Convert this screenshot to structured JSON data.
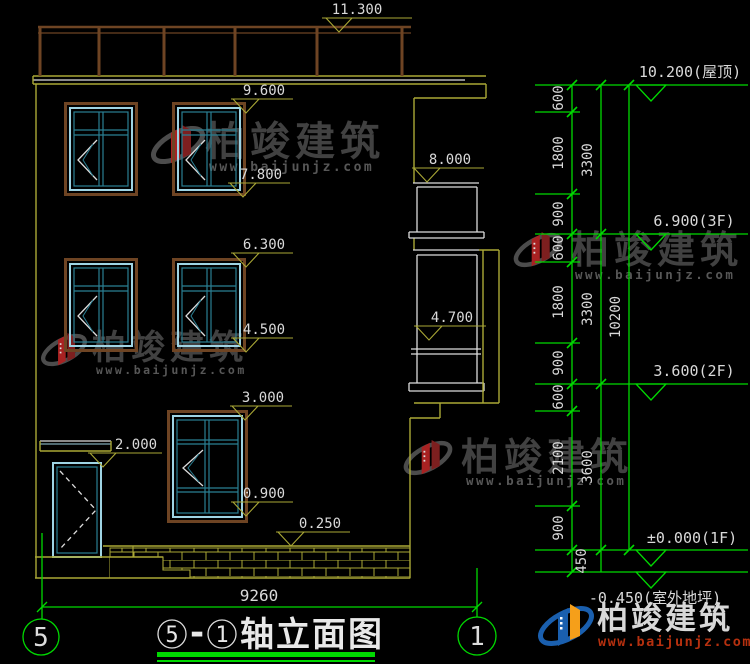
{
  "watermark": {
    "brand": "柏竣建筑",
    "url": "www.baijunjz.com"
  },
  "logo": {
    "brand": "柏竣建筑",
    "url": "www.baijunjz.com"
  },
  "left_markers": [
    "11.300",
    "9.600",
    "7.800",
    "6.300",
    "4.500",
    "3.000",
    "0.900",
    "2.000",
    "0.250",
    "8.000",
    "4.700"
  ],
  "right_markers": [
    "10.200(屋顶)",
    "6.900(3F)",
    "3.600(2F)",
    "±0.000(1F)",
    "-0.450(室外地坪)"
  ],
  "chain1": [
    "600",
    "1800",
    "900",
    "600",
    "1800",
    "900",
    "600",
    "2100",
    "900",
    "450"
  ],
  "chain2": [
    "3300",
    "3300",
    "3600"
  ],
  "chain3": [
    "10200"
  ],
  "bottom_dim": "9260",
  "axis_left": "5",
  "axis_right": "1",
  "title": {
    "c1": "5",
    "dash": "-",
    "c2": "1",
    "text": "轴立面图"
  }
}
